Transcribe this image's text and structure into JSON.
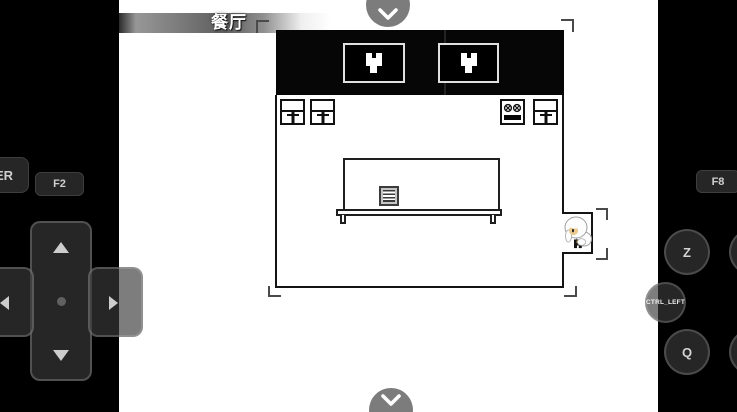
{
  "hud": {
    "location_banner": "餐厅",
    "top_nav_icon": "chevron-down",
    "bottom_nav_icon": "chevron-down"
  },
  "touch_controls": {
    "enter_button_label": "ER",
    "f2_button_label": "F2",
    "f8_button_label": "F8",
    "z_button_label": "Z",
    "ctrl_left_button_label": "CTRL_LEFT",
    "q_button_label": "Q",
    "dpad_icons": {
      "up": "up-arrow",
      "down": "down-arrow",
      "left": "left-arrow",
      "right": "right-arrow",
      "center": "center-dot"
    }
  },
  "scene": {
    "room_name": "餐厅",
    "objects": [
      "wall-frame-heart-emblem",
      "wall-frame-heart-emblem",
      "chair",
      "chair",
      "stove",
      "chair",
      "long-table",
      "menu-book",
      "white-haired-character"
    ],
    "markers": [
      "camera-bounds-corner-brackets",
      "character-focus-brackets"
    ]
  },
  "colors": {
    "panel_black": "#000000",
    "game_background": "#ffffff",
    "wall_black": "#060606",
    "overlay_gray": "rgba(58,58,58,0.66)",
    "button_dark": "#262626",
    "button_text": "#cfcfcf",
    "banner_text": "#ffffff"
  }
}
